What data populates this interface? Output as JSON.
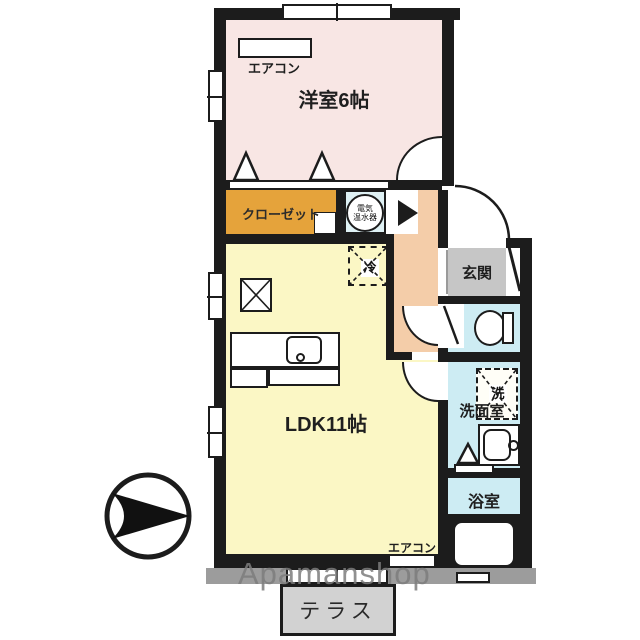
{
  "watermark": "Apamanshop",
  "rooms": {
    "western_room": "洋室6帖",
    "closet": "クローゼット",
    "water_heater_line1": "電気",
    "water_heater_line2": "温水器",
    "entrance": "玄関",
    "ldk": "LDK11帖",
    "washroom": "洗面室",
    "bathroom": "浴室",
    "terrace": "テラス"
  },
  "labels": {
    "aircon_bedroom": "エアコン",
    "aircon_ldk": "エアコン",
    "refrigerator": "冷",
    "washing_machine": "洗"
  },
  "colors": {
    "wall": "#1c1c1c",
    "room-pink": "#f8e6e4",
    "closet-orange": "#e5a33b",
    "heater-cyan": "#dff1f4",
    "hall-salmon": "#f4cda9",
    "genkan-gray": "#c6c6c6",
    "ldk-yellow": "#fbf7c5",
    "wet-blue": "#cdecf3",
    "terrace": "#d2d2d2",
    "shadow": "#9c9c9c"
  }
}
